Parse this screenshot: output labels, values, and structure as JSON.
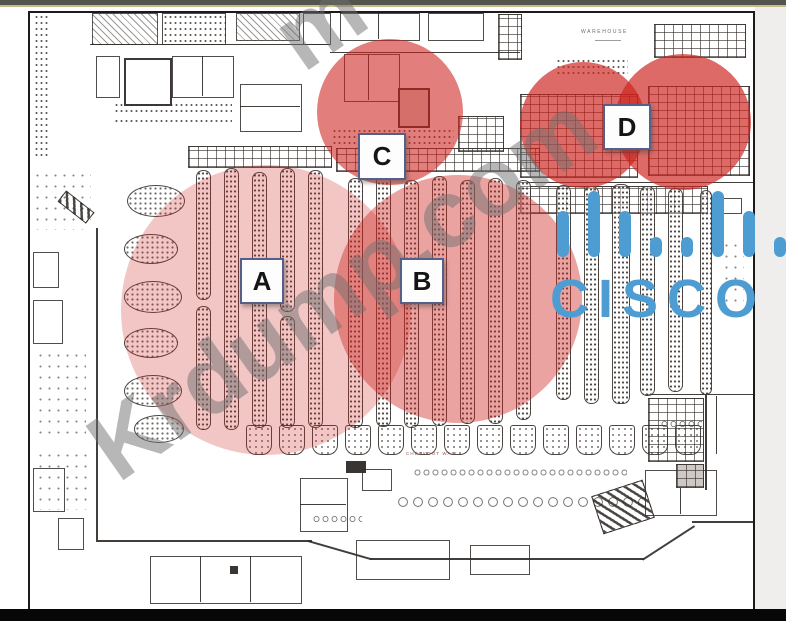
{
  "frame": {
    "top_bar_color": "#53544b",
    "accent_line_color": "#c7ba8a",
    "bottom_bar_color": "#070707",
    "right_panel_color": "#efeeec",
    "plan_border_color": "#1b1b1b"
  },
  "floorplan": {
    "warehouse_label": "WAREHOUSE",
    "checkout_label": "CHECKOUT WALL",
    "ink_color": "#3f3b39"
  },
  "coverage": {
    "base_color": "#cd231e",
    "zones": [
      {
        "id": "A",
        "label": "A",
        "shade": "light"
      },
      {
        "id": "B",
        "label": "B",
        "shade": "medium"
      },
      {
        "id": "C",
        "label": "C",
        "shade": "strong"
      },
      {
        "id": "D",
        "label": "D",
        "shade": "strongest"
      }
    ]
  },
  "watermark": {
    "text": "Krdump.com",
    "fragment": "m",
    "color": "#707070"
  },
  "brand": {
    "name": "CISCO",
    "color": "#4d9dd3"
  }
}
